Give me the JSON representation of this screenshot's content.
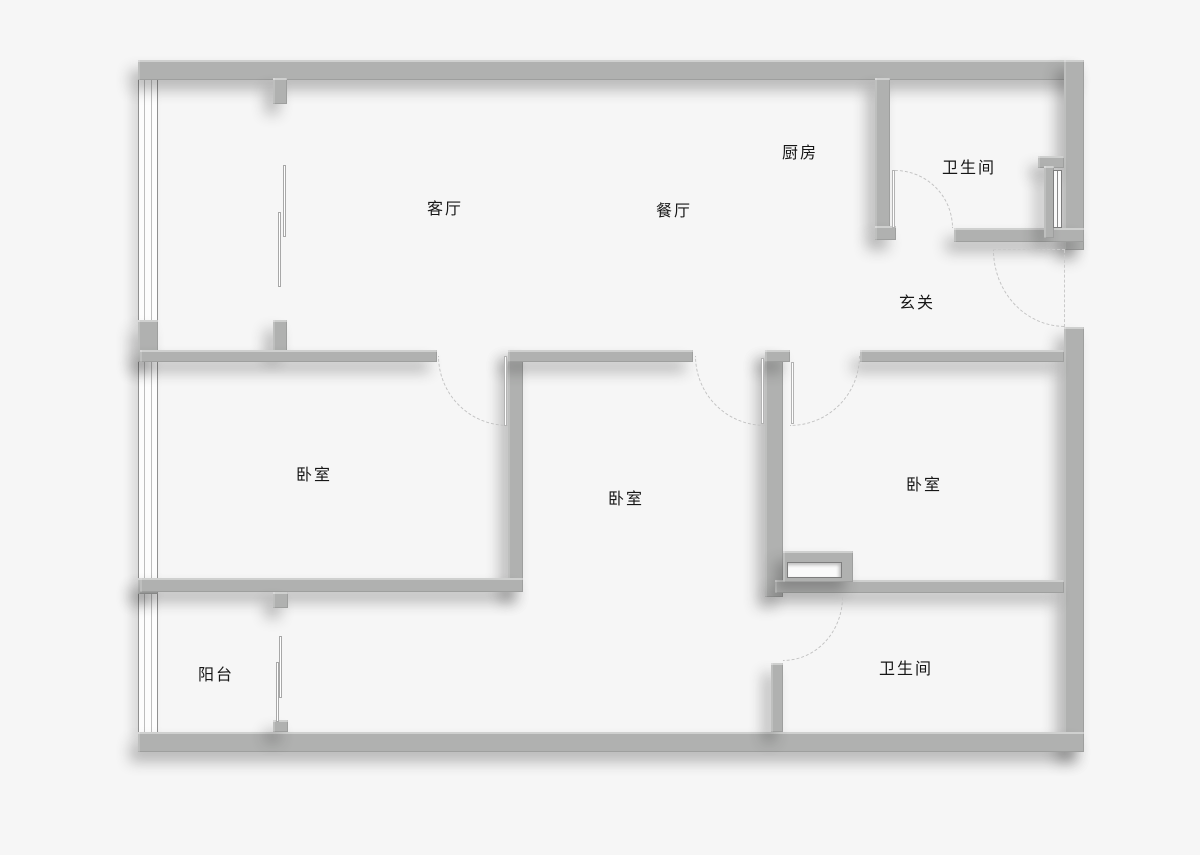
{
  "title": "apartment-floor-plan",
  "canvas": {
    "width": 1200,
    "height": 855,
    "background": "#f6f6f6"
  },
  "colors": {
    "wall": "#b0b1b0",
    "wall_shadow": "rgba(40,40,40,0.30)",
    "window_frame": "#909090",
    "door_arc": "#c2c2c2",
    "label_text": "#161616",
    "floor": "#ffffff"
  },
  "rooms": [
    {
      "id": "living-room",
      "label": "客厅",
      "x": 445,
      "y": 207
    },
    {
      "id": "dining-room",
      "label": "餐厅",
      "x": 674,
      "y": 209
    },
    {
      "id": "kitchen",
      "label": "厨房",
      "x": 800,
      "y": 151
    },
    {
      "id": "bathroom-top",
      "label": "卫生间",
      "x": 969,
      "y": 166
    },
    {
      "id": "entry-hall",
      "label": "玄关",
      "x": 917,
      "y": 301
    },
    {
      "id": "bedroom-left",
      "label": "卧室",
      "x": 314,
      "y": 473
    },
    {
      "id": "bedroom-middle",
      "label": "卧室",
      "x": 626,
      "y": 497
    },
    {
      "id": "bedroom-right",
      "label": "卧室",
      "x": 924,
      "y": 483
    },
    {
      "id": "balcony",
      "label": "阳台",
      "x": 216,
      "y": 673
    },
    {
      "id": "bathroom-bottom",
      "label": "卫生间",
      "x": 906,
      "y": 667
    }
  ],
  "walls": [
    {
      "name": "outer-wall-top",
      "x": 138,
      "y": 60,
      "w": 946,
      "h": 20
    },
    {
      "name": "outer-wall-right-upper",
      "x": 1064,
      "y": 60,
      "w": 20,
      "h": 190
    },
    {
      "name": "outer-wall-right-lower",
      "x": 1064,
      "y": 327,
      "w": 20,
      "h": 425
    },
    {
      "name": "outer-wall-bottom",
      "x": 138,
      "y": 732,
      "w": 946,
      "h": 20
    },
    {
      "name": "pillar-left-middle",
      "x": 138,
      "y": 320,
      "w": 20,
      "h": 42
    },
    {
      "name": "pillar-left-lower",
      "x": 138,
      "y": 578,
      "w": 20,
      "h": 16
    },
    {
      "name": "stub-top-strip-upper",
      "x": 273,
      "y": 78,
      "w": 14,
      "h": 26
    },
    {
      "name": "stub-top-strip-lower",
      "x": 273,
      "y": 320,
      "w": 14,
      "h": 32
    },
    {
      "name": "wall-living-bedleft",
      "x": 140,
      "y": 350,
      "w": 297,
      "h": 12
    },
    {
      "name": "wall-bedleft-bedmid-vert",
      "x": 508,
      "y": 350,
      "w": 15,
      "h": 242
    },
    {
      "name": "wall-bedmid-top",
      "x": 508,
      "y": 350,
      "w": 185,
      "h": 12
    },
    {
      "name": "wall-bedleft-balcony",
      "x": 140,
      "y": 578,
      "w": 383,
      "h": 14
    },
    {
      "name": "wall-bedmid-hall-vert",
      "x": 765,
      "y": 350,
      "w": 18,
      "h": 247
    },
    {
      "name": "wall-bedmid-hall-cap",
      "x": 765,
      "y": 350,
      "w": 25,
      "h": 12
    },
    {
      "name": "wall-bedright-top",
      "x": 860,
      "y": 350,
      "w": 204,
      "h": 12
    },
    {
      "name": "wall-kitchen-bath",
      "x": 875,
      "y": 78,
      "w": 15,
      "h": 150
    },
    {
      "name": "wall-kitchen-bath-foot",
      "x": 875,
      "y": 226,
      "w": 21,
      "h": 14
    },
    {
      "name": "wall-bathtop-bottom",
      "x": 954,
      "y": 228,
      "w": 130,
      "h": 14
    },
    {
      "name": "shaft-stub",
      "x": 1038,
      "y": 156,
      "w": 26,
      "h": 12
    },
    {
      "name": "shaft-wall",
      "x": 1044,
      "y": 166,
      "w": 10,
      "h": 72
    },
    {
      "name": "wall-bathbottom-left",
      "x": 771,
      "y": 663,
      "w": 12,
      "h": 69
    },
    {
      "name": "wall-bedright-bottom",
      "x": 775,
      "y": 580,
      "w": 289,
      "h": 13
    },
    {
      "name": "wall-window-section",
      "x": 783,
      "y": 551,
      "w": 70,
      "h": 31
    },
    {
      "name": "stub-balcony-upper",
      "x": 273,
      "y": 592,
      "w": 15,
      "h": 16
    },
    {
      "name": "stub-balcony-lower",
      "x": 273,
      "y": 720,
      "w": 15,
      "h": 12
    }
  ],
  "window_bands": [
    {
      "name": "left-window-top-strip",
      "x": 138,
      "y": 80,
      "w": 20,
      "h": 240
    },
    {
      "name": "left-window-bedroom",
      "x": 138,
      "y": 362,
      "w": 20,
      "h": 216
    },
    {
      "name": "left-window-balcony",
      "x": 138,
      "y": 594,
      "w": 20,
      "h": 138
    }
  ],
  "glass_panels": [
    {
      "name": "sliding-panel-strip-a",
      "x": 283,
      "y": 165,
      "w": 3,
      "h": 72
    },
    {
      "name": "sliding-panel-strip-b",
      "x": 278,
      "y": 212,
      "w": 3,
      "h": 75
    },
    {
      "name": "sliding-panel-balcony-a",
      "x": 279,
      "y": 636,
      "w": 3,
      "h": 62
    },
    {
      "name": "sliding-panel-balcony-b",
      "x": 276,
      "y": 662,
      "w": 3,
      "h": 60
    }
  ],
  "interior_windows": [
    {
      "name": "window-bedright-bath",
      "type": "h",
      "x": 787,
      "y": 562,
      "w": 55,
      "h": 16
    },
    {
      "name": "window-shaft",
      "type": "v",
      "x": 1053,
      "y": 170,
      "w": 9,
      "h": 58
    }
  ],
  "door_leaves": [
    {
      "name": "leaf-bedroom-left",
      "x": 504,
      "y": 356,
      "w": 3,
      "h": 70
    },
    {
      "name": "leaf-bedroom-middle",
      "x": 761,
      "y": 358,
      "w": 3,
      "h": 66
    },
    {
      "name": "leaf-bedroom-right",
      "x": 791,
      "y": 362,
      "w": 3,
      "h": 62
    },
    {
      "name": "leaf-bathroom-top",
      "x": 892,
      "y": 170,
      "w": 3,
      "h": 58
    }
  ],
  "door_arcs": [
    {
      "name": "arc-bedroom-left",
      "corner": "bl",
      "x": 438,
      "y": 356,
      "w": 70,
      "h": 70
    },
    {
      "name": "arc-bedroom-middle",
      "corner": "bl",
      "x": 695,
      "y": 356,
      "w": 70,
      "h": 70
    },
    {
      "name": "arc-bedroom-right",
      "corner": "br",
      "x": 790,
      "y": 356,
      "w": 70,
      "h": 70
    },
    {
      "name": "arc-bathroom-top",
      "corner": "tr",
      "x": 895,
      "y": 170,
      "w": 58,
      "h": 58
    },
    {
      "name": "arc-bathroom-bottom",
      "corner": "br",
      "x": 783,
      "y": 597,
      "w": 60,
      "h": 64
    },
    {
      "name": "arc-entry-door",
      "corner": "bl",
      "x": 993,
      "y": 250,
      "w": 72,
      "h": 77
    }
  ],
  "dashed_lines": [
    {
      "name": "entry-door-closed-line",
      "type": "h",
      "x": 993,
      "y": 249,
      "len": 72
    },
    {
      "name": "entry-door-open-line",
      "type": "v",
      "x": 1064,
      "y": 250,
      "len": 77
    }
  ]
}
